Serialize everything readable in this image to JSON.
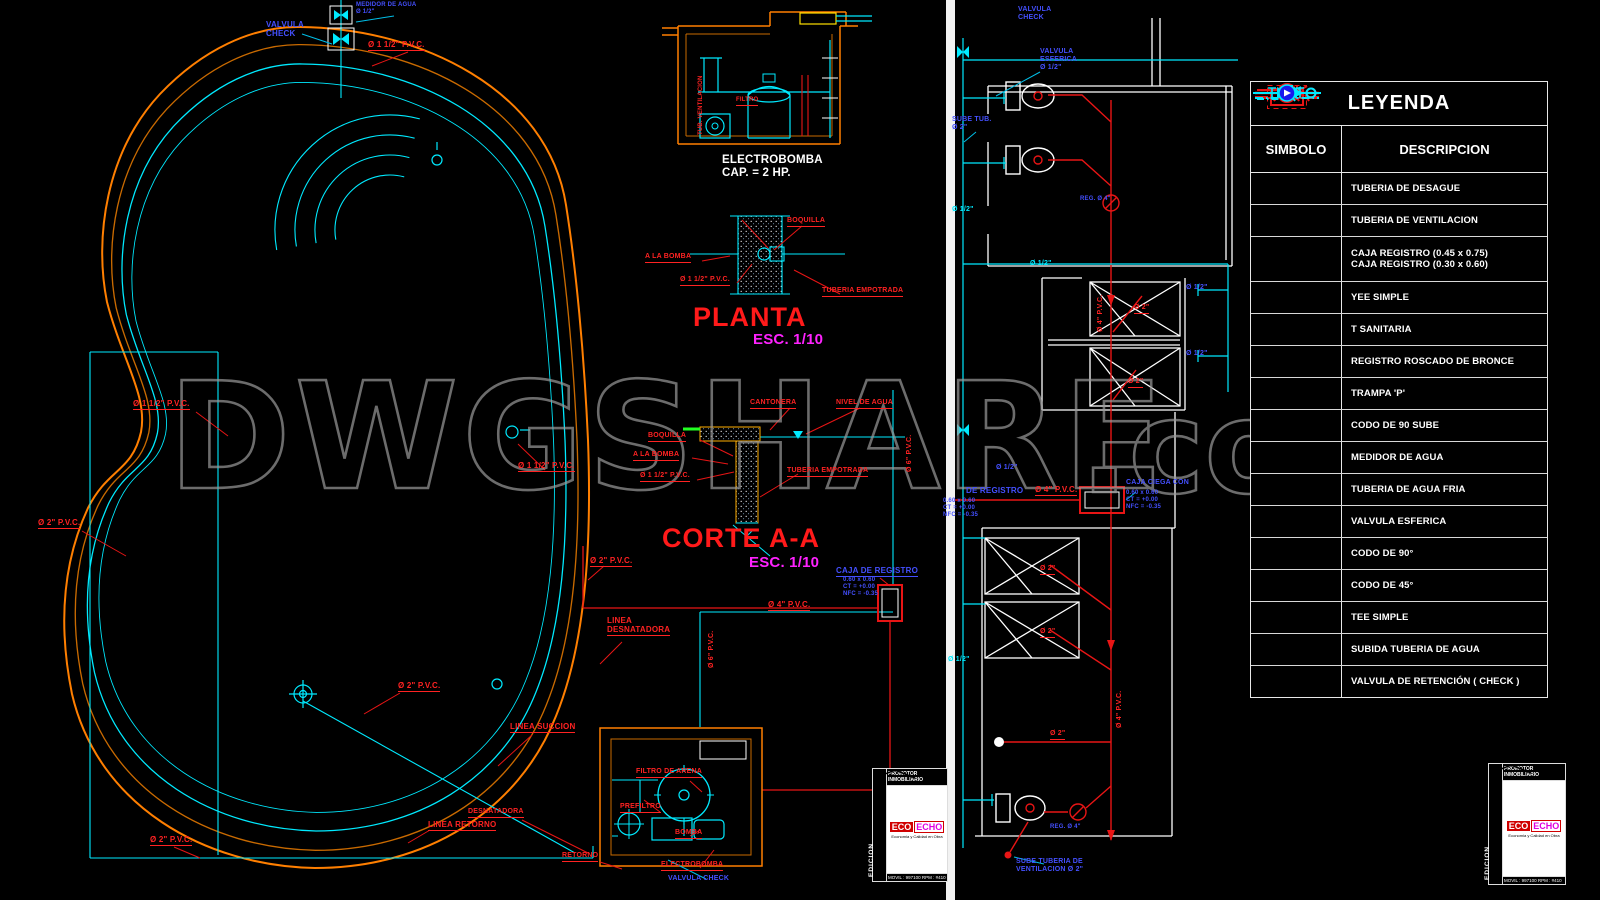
{
  "watermark": {
    "text": "DWGSHARE",
    "suffix": ".com",
    "color": "#9a9a9a"
  },
  "colors": {
    "red": "#ff2222",
    "orange": "#ff7f00",
    "cyan": "#00eaff",
    "blue": "#4450ff",
    "magenta": "#ff22ff",
    "green": "#22ff22",
    "yellow": "#ffe000",
    "white": "#ffffff"
  },
  "common": {
    "pvc112": "Ø 1 1/2\" P.V.C.",
    "pvc2": "Ø 2\" P.V.C.",
    "pvc4": "Ø 4\" P.V.C.",
    "pvc6": "Ø 6\" P.V.C.",
    "d12": "Ø 1/2\"",
    "d2": "Ø 2\"",
    "caja_det": "0.60 x 0.60\nCT = +0.00\nNFC = -0.35"
  },
  "left": {
    "titles": {
      "planta": "PLANTA",
      "planta_esc": "ESC. 1/10",
      "corte": "CORTE A-A",
      "corte_esc": "ESC. 1/10",
      "electrobomba": "ELECTROBOMBA\nCAP. = 2 HP."
    },
    "labels": {
      "medidor": "MEDIDOR DE AGUA\nØ 1/2\"",
      "valvula_check": "VALVULA\nCHECK",
      "linea_desnatadora": "LINEA\nDESNATADORA",
      "linea_succion": "LINEA SUCCION",
      "linea_retorno": "LINEA RETORNO",
      "desnatadora": "DESNATADORA",
      "retorno": "RETORNO",
      "caja_registro": "CAJA DE REGISTRO",
      "a_la_bomba": "A LA BOMBA",
      "boquilla": "BOQUILLA",
      "tuberia_empotrada": "TUBERIA EMPOTRADA",
      "cantonera": "CANTONERA",
      "nivel_agua": "NIVEL DE AGUA",
      "filtro_arena": "FILTRO DE ARENA",
      "prefiltro": "PREFILTRO",
      "bomba": "BOMBA",
      "electrobomba": "ELECTROBOMBA",
      "valvula_check_plan": "VALVULA CHECK",
      "tub_vent": "TUB. VENTILACION",
      "filtro": "FILTRO"
    }
  },
  "right": {
    "labels": {
      "valvula_top": "VALVULA\nCHECK",
      "valvula_esferica": "VALVULA\nESFERICA\nØ 1/2\"",
      "sube_tub": "SUBE TUB.\nØ 2\"",
      "reg4": "REG. Ø 4\"",
      "de_registro": "DE REGISTRO",
      "caja_ciega": "CAJA CIEGA CON",
      "sube_vent": "SUBE TUBERIA DE\nVENTILACION Ø 2\""
    }
  },
  "legend": {
    "title": "LEYENDA",
    "col_symbol": "SIMBOLO",
    "col_desc": "DESCRIPCION",
    "rows": [
      {
        "desc": "TUBERIA DE DESAGUE",
        "symbol": "tuberia-desague"
      },
      {
        "desc": "TUBERIA DE VENTILACION",
        "symbol": "tuberia-ventilacion"
      },
      {
        "desc": "CAJA REGISTRO (0.45 x 0.75)",
        "desc2": "CAJA REGISTRO (0.30 x 0.60)",
        "symbol": "caja-registro"
      },
      {
        "desc": "YEE SIMPLE",
        "symbol": "yee-simple"
      },
      {
        "desc": "T SANITARIA",
        "symbol": "t-sanitaria"
      },
      {
        "desc": "REGISTRO ROSCADO DE BRONCE",
        "symbol": "registro-roscado"
      },
      {
        "desc": "TRAMPA 'P'",
        "symbol": "trampa-p"
      },
      {
        "desc": "CODO DE 90 SUBE",
        "symbol": "codo-90-sube"
      },
      {
        "desc": "MEDIDOR DE AGUA",
        "symbol": "medidor-agua"
      },
      {
        "desc": "TUBERIA DE AGUA FRIA",
        "symbol": "tuberia-agua-fria"
      },
      {
        "desc": "VALVULA ESFERICA",
        "symbol": "valvula-esferica"
      },
      {
        "desc": "CODO DE 90°",
        "symbol": "codo-90"
      },
      {
        "desc": "CODO DE 45°",
        "symbol": "codo-45"
      },
      {
        "desc": "TEE SIMPLE",
        "symbol": "tee-simple"
      },
      {
        "desc": "SUBIDA TUBERIA DE AGUA",
        "symbol": "subida-tuberia"
      },
      {
        "desc": "VALVULA DE RETENCIÓN ( CHECK )",
        "symbol": "valvula-retencion"
      }
    ]
  },
  "title_block": {
    "header": "PROMOTOR INMOBILIARIO",
    "logo_left": "ECO",
    "logo_right": "ECHO",
    "tagline": "Economia y Calidad en Obra",
    "contact": "MOVIL : 997100   RPM : #410",
    "vertical": "EDICION"
  }
}
